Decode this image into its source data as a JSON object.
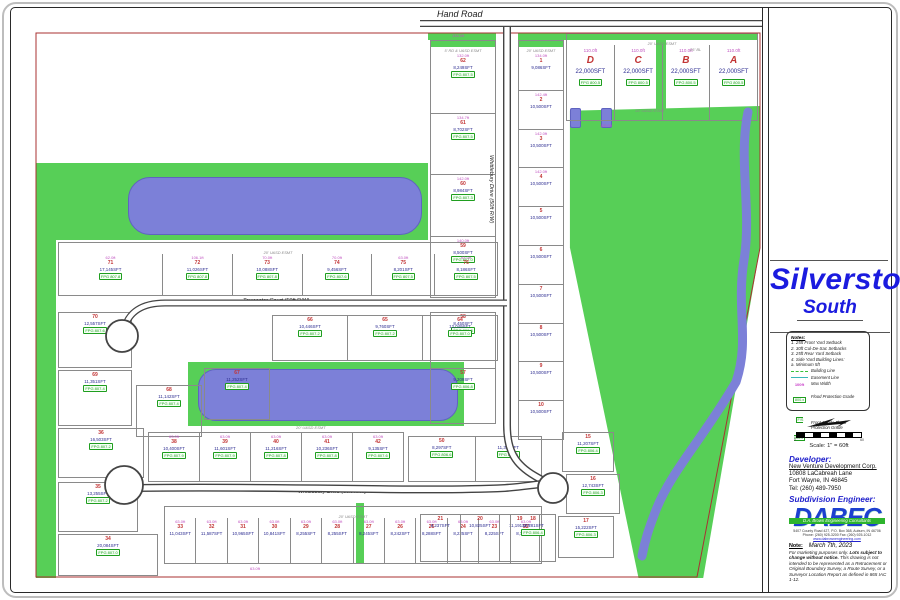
{
  "colors": {
    "green": "#57cf57",
    "pond": "#7c80d8",
    "title_blue": "#1b1bdf",
    "lot_number_red": "#c23434",
    "sqft_blue": "#2b2b90",
    "dimension_magenta": "#c052c0",
    "fpg_green": "#1f9e1f",
    "boundary_red": "#a83232",
    "road_dark": "#444444",
    "logo_blue": "#1d3fd0",
    "banner_green": "#2db42d"
  },
  "map": {
    "hand_road": "Hand Road",
    "road_vertical": "Whittlebury Drive (50ft R/W)",
    "road_towcester": "Towcester Court (50ft R/W)",
    "road_whittlebury": "Whittlebury Drive (50ft R/W)",
    "greens": [
      {
        "x": 36,
        "y": 163,
        "w": 392,
        "h": 77
      },
      {
        "x": 36,
        "y": 240,
        "w": 20,
        "h": 338
      },
      {
        "x": 188,
        "y": 362,
        "w": 276,
        "h": 64
      },
      {
        "x": 566,
        "y": 106,
        "w": 196,
        "h": 472,
        "clip": "polygon(2% 1%, 99% 0%, 99% 30%, 70% 100%, 37% 100%, 2% 30%)"
      },
      {
        "x": 656,
        "y": 33,
        "w": 10,
        "h": 88
      },
      {
        "x": 356,
        "y": 503,
        "w": 8,
        "h": 60
      },
      {
        "x": 428,
        "y": 33,
        "w": 68,
        "h": 7
      },
      {
        "x": 518,
        "y": 33,
        "w": 48,
        "h": 7
      }
    ],
    "ponds": [
      {
        "x": 128,
        "y": 177,
        "w": 292,
        "h": 56,
        "r": 22
      },
      {
        "x": 198,
        "y": 369,
        "w": 258,
        "h": 50,
        "r": 18
      },
      {
        "x": 570,
        "y": 108,
        "w": 9,
        "h": 18,
        "r": 2
      },
      {
        "x": 601,
        "y": 108,
        "w": 9,
        "h": 18,
        "r": 2
      }
    ],
    "labels": [
      {
        "t": "Hand Road",
        "x": 437,
        "y": 9,
        "sz": 9,
        "cls": "road"
      },
      {
        "t": "Towcester Court (50ft R/W)",
        "x": 243,
        "y": 298,
        "sz": 5.5,
        "cls": "road"
      },
      {
        "t": "Whittlebury Drive (50ft R/W)",
        "x": 298,
        "y": 489,
        "sz": 5.5,
        "cls": "road"
      },
      {
        "t": "Whittlebury Drive (50ft R/W)",
        "x": 494,
        "y": 155,
        "sz": 5.5,
        "cls": "road",
        "rot": 90
      },
      {
        "t": "15' U&SD ESMT",
        "x": 635,
        "y": 108,
        "sz": 4,
        "cls": "esmt"
      },
      {
        "t": "25' BL",
        "x": 690,
        "y": 47,
        "sz": 4,
        "cls": "esmt"
      },
      {
        "t": "20' U&SD ESMT",
        "x": 296,
        "y": 425,
        "sz": 4,
        "cls": "esmt"
      },
      {
        "t": "134.0ft",
        "x": 452,
        "y": 34,
        "sz": 4,
        "cls": "dim"
      },
      {
        "t": "110.0ft",
        "x": 600,
        "y": 124,
        "sz": 4,
        "cls": "dim"
      },
      {
        "t": "63.0ft",
        "x": 250,
        "y": 567,
        "sz": 4,
        "cls": "dim"
      }
    ],
    "blocks": [
      {
        "name": "col-left-of-road",
        "x": 430,
        "y": 40,
        "w": 66,
        "h": 258,
        "dir": "v",
        "strip": true,
        "esmt": "5' RD & U&SD ESMT",
        "cells": [
          {
            "n": "62",
            "sqft": "8,249SFT",
            "fpg": "FPG 807.5",
            "dim": "132.0ft"
          },
          {
            "n": "61",
            "sqft": "8,702SFT",
            "fpg": "FPG 807.5",
            "dim": "134.7ft"
          },
          {
            "n": "60",
            "sqft": "8,984SFT",
            "fpg": "FPG 807.3",
            "dim": "142.0ft"
          },
          {
            "n": "59",
            "sqft": "8,500SFT",
            "fpg": "FPG 807.0",
            "dim": "140.0ft"
          }
        ]
      },
      {
        "name": "col-left-of-road-lower",
        "x": 430,
        "y": 312,
        "w": 66,
        "h": 112,
        "dir": "v",
        "cells": [
          {
            "n": "58",
            "sqft": "8,450SFT",
            "fpg": "FPG 806.8"
          },
          {
            "n": "57",
            "sqft": "9,209SFT",
            "fpg": "FPG 806.8"
          }
        ]
      },
      {
        "name": "col-right-of-road",
        "x": 518,
        "y": 40,
        "w": 46,
        "h": 400,
        "dir": "v",
        "strip": true,
        "esmt": "20' U&SD ESMT",
        "cells": [
          {
            "n": "1",
            "sqft": "9,086SFT",
            "dim": "134.0ft"
          },
          {
            "n": "2",
            "sqft": "10,500SFT",
            "dim": "142.4ft"
          },
          {
            "n": "3",
            "sqft": "10,500SFT",
            "dim": "142.0ft"
          },
          {
            "n": "4",
            "sqft": "10,500SFT",
            "dim": "142.0ft"
          },
          {
            "n": "5",
            "sqft": "10,500SFT"
          },
          {
            "n": "6",
            "sqft": "10,500SFT"
          },
          {
            "n": "7",
            "sqft": "10,500SFT"
          },
          {
            "n": "8",
            "sqft": "10,500SFT"
          },
          {
            "n": "9",
            "sqft": "10,500SFT"
          },
          {
            "n": "10",
            "sqft": "10,500SFT"
          }
        ]
      },
      {
        "name": "block-abcd",
        "x": 566,
        "y": 33,
        "w": 192,
        "h": 88,
        "dir": "h",
        "big": true,
        "strip": true,
        "esmt": "20' U&SD ESMT",
        "dim": "110.0ft",
        "cells": [
          {
            "n": "D",
            "sqft": "22,000SFT",
            "fpg": "FPG 800.5"
          },
          {
            "n": "C",
            "sqft": "22,000SFT",
            "fpg": "FPG 800.5"
          },
          {
            "n": "B",
            "sqft": "22,000SFT",
            "fpg": "FPG 800.5"
          },
          {
            "n": "A",
            "sqft": "22,000SFT",
            "fpg": "FPG 800.5"
          }
        ]
      },
      {
        "name": "row-above-towcester",
        "x": 58,
        "y": 242,
        "w": 440,
        "h": 54,
        "dir": "h",
        "esmt": "20' U&SD ESMT",
        "cells": [
          {
            "n": "71",
            "sqft": "17,145SFT",
            "fpg": "FPG 807.8",
            "dim": "62.0ft",
            "fw": 1.5
          },
          {
            "n": "72",
            "sqft": "11,026SFT",
            "fpg": "FPG 807.8",
            "dim": "106.1ft"
          },
          {
            "n": "73",
            "sqft": "10,088SFT",
            "fpg": "FPG 807.8",
            "dim": "70.0ft"
          },
          {
            "n": "74",
            "sqft": "9,456SFT",
            "fpg": "FPG 807.6",
            "dim": "70.0ft"
          },
          {
            "n": "75",
            "sqft": "8,201SFT",
            "fpg": "FPG 807.5",
            "dim": "63.0ft",
            "fw": 0.9
          },
          {
            "n": "76",
            "sqft": "8,186SFT",
            "fpg": "FPG 807.5",
            "dim": "63.0ft",
            "fw": 0.9
          }
        ]
      },
      {
        "name": "lot-70",
        "x": 58,
        "y": 312,
        "w": 74,
        "h": 56,
        "dir": "h",
        "cells": [
          {
            "n": "70",
            "sqft": "12,557SFT",
            "fpg": "FPG 807.6"
          }
        ]
      },
      {
        "name": "lot-69",
        "x": 58,
        "y": 370,
        "w": 74,
        "h": 56,
        "dir": "h",
        "cells": [
          {
            "n": "69",
            "sqft": "11,351SFT",
            "fpg": "FPG 807.4"
          }
        ]
      },
      {
        "name": "lot-68",
        "x": 136,
        "y": 385,
        "w": 66,
        "h": 52,
        "dir": "h",
        "cells": [
          {
            "n": "68",
            "sqft": "11,142SFT",
            "fpg": "FPG 807.4"
          }
        ]
      },
      {
        "name": "lot-67",
        "x": 204,
        "y": 368,
        "w": 66,
        "h": 52,
        "dir": "h",
        "cells": [
          {
            "n": "67",
            "sqft": "11,252SFT",
            "fpg": "FPG 807.4"
          }
        ]
      },
      {
        "name": "row-below-towcester-east",
        "x": 272,
        "y": 315,
        "w": 226,
        "h": 46,
        "dir": "h",
        "cells": [
          {
            "n": "66",
            "sqft": "10,446SFT",
            "fpg": "FPG 807.2"
          },
          {
            "n": "65",
            "sqft": "9,760SFT",
            "fpg": "FPG 807.2"
          },
          {
            "n": "64",
            "sqft": "12,049SFT",
            "fpg": "FPG 807.0"
          }
        ]
      },
      {
        "name": "row-above-whittlebury",
        "x": 148,
        "y": 432,
        "w": 256,
        "h": 50,
        "dir": "h",
        "cells": [
          {
            "n": "38",
            "sqft": "10,400SFT",
            "fpg": "FPG 807.9",
            "dim": "63.0ft"
          },
          {
            "n": "39",
            "sqft": "11,601SFT",
            "fpg": "FPG 807.9",
            "dim": "63.0ft"
          },
          {
            "n": "40",
            "sqft": "11,216SFT",
            "fpg": "FPG 807.8",
            "dim": "63.0ft"
          },
          {
            "n": "41",
            "sqft": "10,236SFT",
            "fpg": "FPG 807.8",
            "dim": "63.0ft"
          },
          {
            "n": "42",
            "sqft": "9,135SFT",
            "fpg": "FPG 807.6",
            "dim": "63.0ft"
          }
        ]
      },
      {
        "name": "row-above-whittlebury-east",
        "x": 408,
        "y": 436,
        "w": 134,
        "h": 46,
        "dir": "h",
        "cells": [
          {
            "n": "50",
            "sqft": "8,297SFT",
            "fpg": "FPG 806.6"
          },
          {
            "n": "51",
            "sqft": "11,336SFT",
            "fpg": "FPG 806.6"
          }
        ]
      },
      {
        "name": "lot-36",
        "x": 58,
        "y": 428,
        "w": 86,
        "h": 50,
        "dir": "h",
        "cells": [
          {
            "n": "36",
            "sqft": "16,503SFT",
            "fpg": "FPG 807.2"
          }
        ]
      },
      {
        "name": "lot-35",
        "x": 58,
        "y": 482,
        "w": 80,
        "h": 50,
        "dir": "h",
        "cells": [
          {
            "n": "35",
            "sqft": "13,255SFT",
            "fpg": "FPG 807.2"
          }
        ]
      },
      {
        "name": "lot-34",
        "x": 58,
        "y": 534,
        "w": 100,
        "h": 42,
        "dir": "h",
        "cells": [
          {
            "n": "34",
            "sqft": "20,084SFT",
            "fpg": "FPG 807.0"
          }
        ]
      },
      {
        "name": "row-below-whittlebury",
        "x": 164,
        "y": 506,
        "w": 378,
        "h": 58,
        "dir": "h",
        "esmt": "20' U&SD ESMT",
        "dim": "63.0ft",
        "cells": [
          {
            "n": "33",
            "sqft": "11,043SFT"
          },
          {
            "n": "32",
            "sqft": "11,587SFT"
          },
          {
            "n": "31",
            "sqft": "10,965SFT"
          },
          {
            "n": "30",
            "sqft": "10,841SFT"
          },
          {
            "n": "29",
            "sqft": "8,255SFT"
          },
          {
            "n": "28",
            "sqft": "8,255SFT"
          },
          {
            "n": "27",
            "sqft": "8,245SFT"
          },
          {
            "n": "26",
            "sqft": "8,242SFT"
          },
          {
            "n": "25",
            "sqft": "8,288SFT"
          },
          {
            "n": "24",
            "sqft": "8,225SFT"
          },
          {
            "n": "23",
            "sqft": "8,225SFT"
          },
          {
            "n": "22",
            "sqft": "8,775SFT"
          }
        ]
      },
      {
        "name": "row-east-end",
        "x": 420,
        "y": 514,
        "w": 120,
        "h": 48,
        "dir": "h",
        "cells": [
          {
            "n": "21",
            "sqft": "8,237SFT"
          },
          {
            "n": "20",
            "sqft": "10,825SFT"
          },
          {
            "n": "19",
            "sqft": "11,191SFT"
          }
        ]
      },
      {
        "name": "lot-18",
        "x": 510,
        "y": 514,
        "w": 46,
        "h": 48,
        "dir": "h",
        "cells": [
          {
            "n": "18",
            "sqft": "12,281SFT",
            "fpg": "FPG 806.4"
          }
        ]
      },
      {
        "name": "lot-15",
        "x": 562,
        "y": 432,
        "w": 52,
        "h": 40,
        "dir": "h",
        "cells": [
          {
            "n": "15",
            "sqft": "11,207SFT",
            "fpg": "FPG 806.4"
          }
        ]
      },
      {
        "name": "lot-16",
        "x": 566,
        "y": 474,
        "w": 54,
        "h": 40,
        "dir": "h",
        "cells": [
          {
            "n": "16",
            "sqft": "12,743SFT",
            "fpg": "FPG 806.3"
          }
        ]
      },
      {
        "name": "lot-17",
        "x": 558,
        "y": 516,
        "w": 56,
        "h": 42,
        "dir": "h",
        "cells": [
          {
            "n": "17",
            "sqft": "15,222SFT",
            "fpg": "FPG 806.3"
          }
        ]
      }
    ]
  },
  "title_block": {
    "title": "Silverstone",
    "subtitle": "South",
    "notes": {
      "heading": "Notes:",
      "items": [
        "1. 25ft Front Yard Setback",
        "2. 30ft Cul-De-Sac Setbacks",
        "3. 25ft Rear Yard Setback",
        "4. Side Yard Building Lines:",
        "    a. Minimum 5ft"
      ]
    },
    "legend": [
      {
        "swatch_text": "",
        "label": "Building Line"
      },
      {
        "swatch_text": "",
        "label": "Easement Line"
      },
      {
        "swatch_text": "100ft",
        "label": "Max Width"
      },
      {
        "swatch_text": "800.x",
        "label": "Flood Protection Grade"
      },
      {
        "swatch_text": "F/S 800.x",
        "label": "Front & Side Flood Protection Grade"
      }
    ],
    "scale": {
      "label": "Scale: 1\" = 60ft",
      "left": "0",
      "right": "60"
    },
    "developer": {
      "heading": "Developer:",
      "name": "New Venture Development Corp.",
      "addr1": "10808 LaCabreah Lane",
      "addr2": "Fort Wayne, IN 46845",
      "tel": "Tel: (260) 489-7950"
    },
    "engineer": {
      "heading": "Subdivision Engineer:",
      "logo": "DABEC",
      "banner": "D.A. Brown Engineering Consultants",
      "addr1": "5407 County Road 427, P.O. Box 368, Auburn, IN 46706",
      "addr2": "Phone: (260) 925-3200      Fax: (260) 925-1012",
      "web": "www.dabrownengineering.com"
    },
    "note": {
      "label": "Note:",
      "date": "March 7th, 2023",
      "body1": "For marketing purposes only. ",
      "bold": "Lots subject to change without notice.",
      "body2": " This drawing is not intended to be represented as a Retracement or Original Boundary Survey, a Route Survey, or a Surveyor Location Report as defined in 865 IAC 1-12."
    }
  }
}
